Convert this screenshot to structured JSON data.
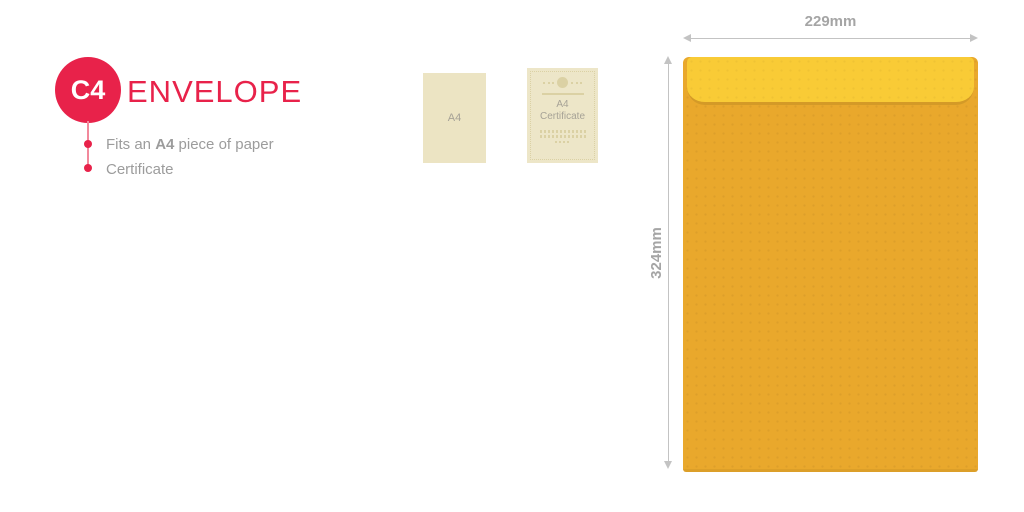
{
  "header": {
    "badge_label": "C4",
    "title": "ENVELOPE"
  },
  "features": [
    {
      "prefix": "Fits an ",
      "bold": "A4",
      "suffix": " piece of paper"
    },
    {
      "prefix": "",
      "bold": "",
      "suffix": "Certificate"
    }
  ],
  "inserts": {
    "a4_sheet": {
      "label": "A4"
    },
    "certificate": {
      "label_line1": "A4",
      "label_line2": "Certificate"
    }
  },
  "envelope": {
    "width_label": "229mm",
    "height_label": "324mm"
  },
  "colors": {
    "accent_red": "#e8224a",
    "accent_red_light": "#f2899c",
    "text_gray": "#9c9c9c",
    "dimension_gray": "#a5a5a5",
    "arrow_gray": "#c3c3c3",
    "envelope_body": "#e9a82c",
    "envelope_body_edge": "#dc9f29",
    "envelope_flap": "#f9cb36",
    "envelope_flap_edge": "#d49a27",
    "paper_cream": "#ece4c3",
    "paper_cream2": "#ede6c8",
    "paper_text": "#a6a296",
    "certificate_decor": "#dbd1a4"
  }
}
